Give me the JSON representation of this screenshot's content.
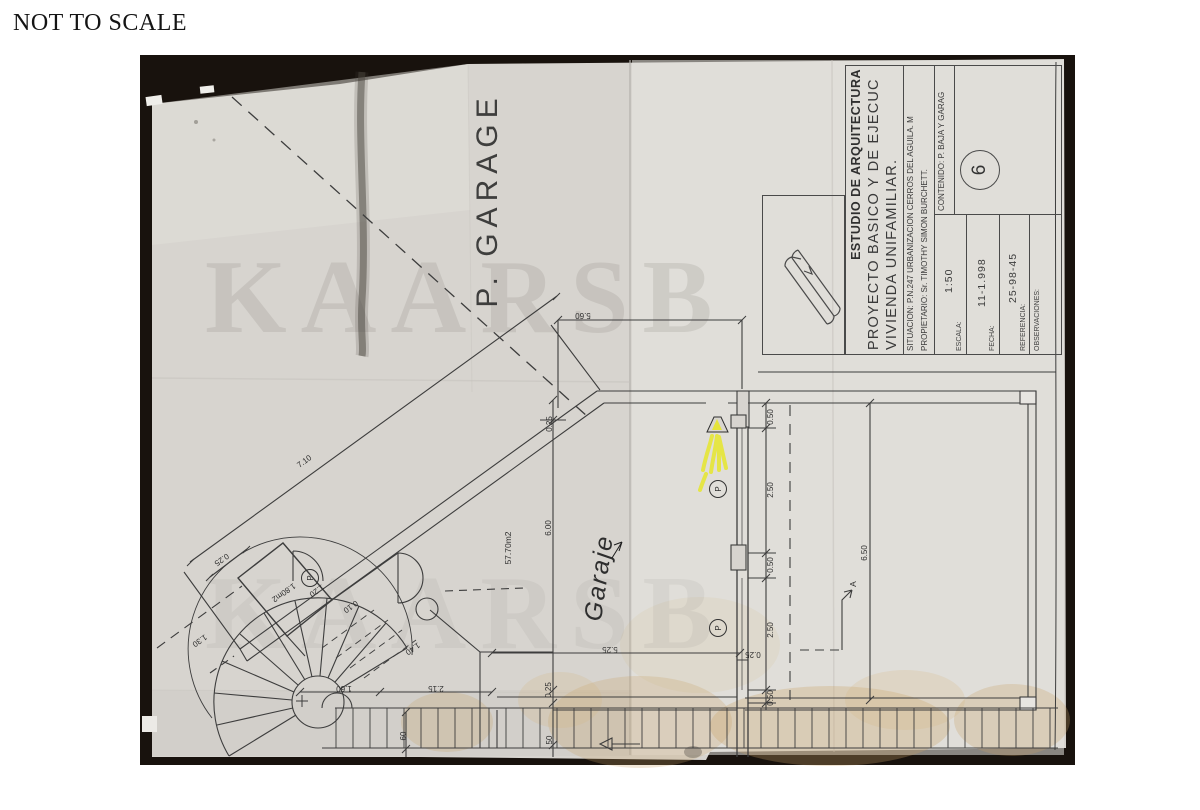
{
  "page": {
    "note": "NOT TO SCALE",
    "watermark": "KAARSB"
  },
  "title_block": {
    "studio": "ESTUDIO DE ARQUITECTURA",
    "project_line1": "PROYECTO BASICO Y DE EJECUC",
    "project_line2": "VIVIENDA UNIFAMILIAR.",
    "situacion_label": "SITUACION:",
    "situacion": "P.N.247 URBANIZACION CERROS DEL AGUILA. M",
    "propietario_label": "PROPIETARIO:",
    "propietario": "Sr. TIMOTHY SIMON BURCHETT.",
    "escala_label": "ESCALA:",
    "escala": "1:50",
    "fecha_label": "FECHA:",
    "fecha": "11-1.998",
    "referencia_label": "REFERENCIA:",
    "referencia": "25-98-45",
    "observaciones_label": "OBSERVACIONES:",
    "contenido_label": "CONTENIDO:",
    "contenido": "P. BAJA Y GARAG",
    "sheet_number": "6"
  },
  "plan": {
    "p_garage": "P. GARAGE",
    "garaje": "Garaje",
    "column_marker": "P",
    "dims": [
      "5.60",
      "0.25",
      "6.00",
      "57.70m2",
      "0.50",
      "2.50",
      "0.50",
      "2.50",
      "0.50",
      "0.25",
      "6.50",
      "A",
      "7.10",
      "0.25",
      "1.80m2",
      "1.20",
      "0.10",
      "1.30",
      "1.40",
      "1.60",
      "2.15",
      "5.25",
      "0.25",
      "50",
      "60"
    ]
  }
}
